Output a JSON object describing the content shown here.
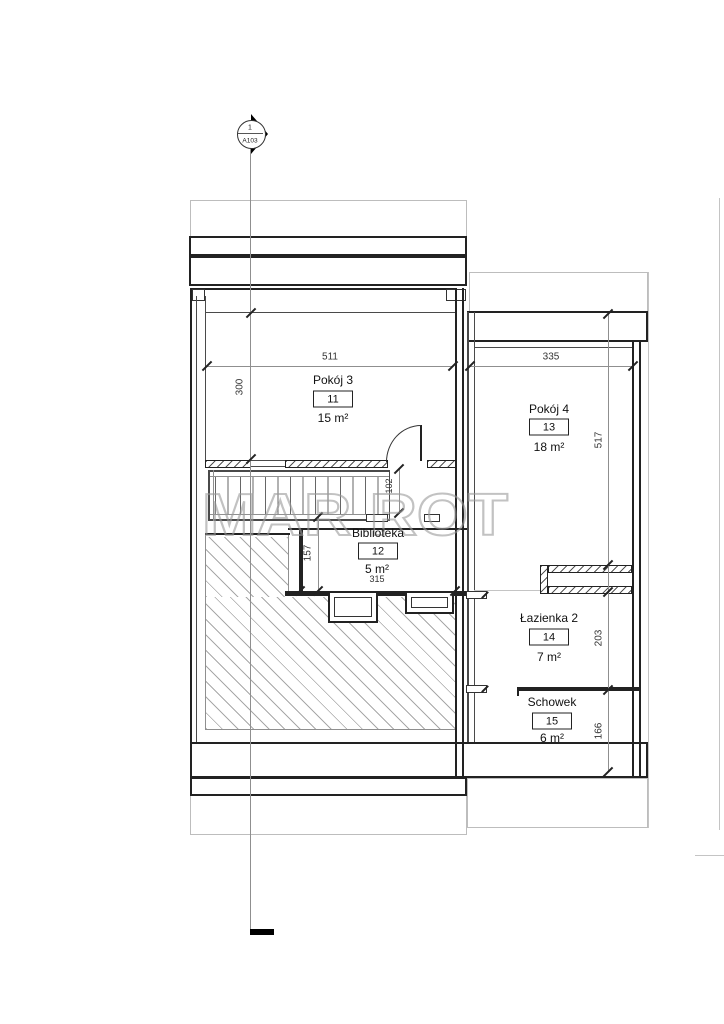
{
  "section_marker": {
    "detail_number": "1",
    "sheet_number": "A103"
  },
  "watermark_text": "MAR ROT",
  "rooms": [
    {
      "name": "Pokój 3",
      "number": "11",
      "area": "15 m²"
    },
    {
      "name": "Pokój 4",
      "number": "13",
      "area": "18 m²"
    },
    {
      "name": "Biblioteka",
      "number": "12",
      "area": "5 m²"
    },
    {
      "name": "Łazienka 2",
      "number": "14",
      "area": "7 m²"
    },
    {
      "name": "Schowek",
      "number": "15",
      "area": "6 m²"
    }
  ],
  "dimensions": {
    "pokoj3_width": "511",
    "pokoj3_height": "300",
    "pokoj4_width": "335",
    "pokoj4_height": "517",
    "stair_opening": "102",
    "void_height": "157",
    "biblioteka_width": "315",
    "lazienka_height": "203",
    "schowek_height": "166"
  },
  "colors": {
    "line_dark": "#222222",
    "line_gray": "#8f8f8f",
    "line_light": "#c4c4c4",
    "watermark": "#9a9a9a",
    "section_arrow": "#000000"
  }
}
